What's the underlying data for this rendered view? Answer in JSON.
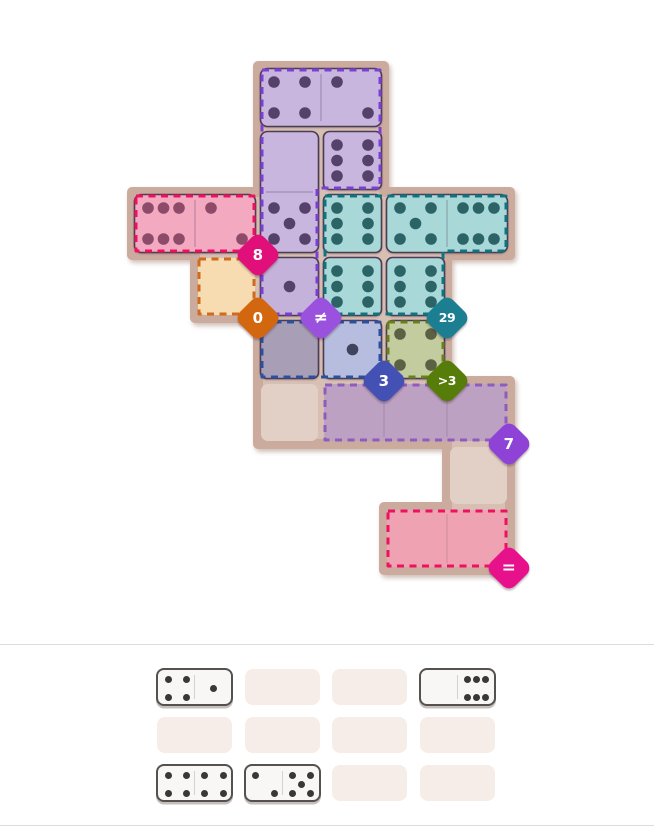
{
  "page": {
    "background": "#ffffff",
    "divider_color": "#dcdcdc",
    "divider_y_top": 644,
    "divider_y_bottom": 825
  },
  "board": {
    "origin": {
      "x": 132,
      "y": 66
    },
    "cell_size": 63,
    "shell": {
      "fill": "#d7bfb4",
      "stroke": "#cbab9e",
      "outline": [
        [
          258,
          66
        ],
        [
          384,
          66
        ],
        [
          384,
          192
        ],
        [
          510,
          192
        ],
        [
          510,
          255
        ],
        [
          447,
          255
        ],
        [
          447,
          381
        ],
        [
          510,
          381
        ],
        [
          510,
          570
        ],
        [
          384,
          570
        ],
        [
          384,
          507
        ],
        [
          447,
          507
        ],
        [
          447,
          444
        ],
        [
          258,
          444
        ],
        [
          258,
          318
        ],
        [
          195,
          318
        ],
        [
          195,
          255
        ],
        [
          132,
          255
        ],
        [
          132,
          192
        ],
        [
          258,
          192
        ]
      ]
    },
    "empty_cells": [
      {
        "name": "cell-cream-empty",
        "col": 1,
        "row": 3,
        "fill": "#f6dcb0"
      },
      {
        "name": "cell-plain-empty-1",
        "col": 2,
        "row": 5,
        "fill": "#e2d0c7"
      },
      {
        "name": "cell-plain-empty-2",
        "col": 5,
        "row": 6,
        "fill": "#e2d0c7"
      }
    ],
    "region_fills": [
      {
        "name": "region-fill-mauve",
        "x": 324,
        "y": 384,
        "w": 183,
        "h": 57,
        "fill": "#bda1c3",
        "dividers_x": [
          384,
          447
        ]
      },
      {
        "name": "region-fill-pink-bottom",
        "x": 387,
        "y": 510,
        "w": 120,
        "h": 57,
        "fill": "#efa3b2",
        "dividers_x": [
          447
        ]
      }
    ],
    "regions": [
      {
        "name": "region-pink-top",
        "dash": "#f01060",
        "points": [
          [
            136,
            196
          ],
          [
            254,
            196
          ],
          [
            254,
            251
          ],
          [
            136,
            251
          ]
        ]
      },
      {
        "name": "region-cream",
        "dash": "#d06a1d",
        "points": [
          [
            199,
            259
          ],
          [
            254,
            259
          ],
          [
            254,
            314
          ],
          [
            199,
            314
          ]
        ]
      },
      {
        "name": "region-purple",
        "dash": "#7c3fd3",
        "points": [
          [
            262,
            70
          ],
          [
            380,
            70
          ],
          [
            380,
            188
          ],
          [
            317,
            188
          ],
          [
            317,
            314
          ],
          [
            262,
            314
          ]
        ]
      },
      {
        "name": "region-teal",
        "dash": "#0f7380",
        "points": [
          [
            325,
            196
          ],
          [
            506,
            196
          ],
          [
            506,
            251
          ],
          [
            443,
            251
          ],
          [
            443,
            314
          ],
          [
            325,
            314
          ]
        ]
      },
      {
        "name": "region-blue",
        "dash": "#2b509f",
        "points": [
          [
            262,
            322
          ],
          [
            380,
            322
          ],
          [
            380,
            377
          ],
          [
            262,
            377
          ]
        ]
      },
      {
        "name": "region-olive",
        "dash": "#68811c",
        "points": [
          [
            388,
            322
          ],
          [
            443,
            322
          ],
          [
            443,
            377
          ],
          [
            388,
            377
          ]
        ]
      },
      {
        "name": "region-mauve",
        "dash": "#8e5cbe",
        "points": [
          [
            325,
            385
          ],
          [
            506,
            385
          ],
          [
            506,
            440
          ],
          [
            325,
            440
          ]
        ]
      },
      {
        "name": "region-pink-bottom",
        "dash": "#f01060",
        "points": [
          [
            388,
            511
          ],
          [
            506,
            511
          ],
          [
            506,
            566
          ],
          [
            388,
            566
          ]
        ]
      }
    ],
    "dominoes": [
      {
        "name": "domino-4-2",
        "merged": true,
        "halves": [
          {
            "col": 2,
            "row": 0,
            "v": "4",
            "fill": "#c9b6df",
            "pip": "#554169"
          },
          {
            "col": 3,
            "row": 0,
            "v": "2",
            "fill": "#c9b6df",
            "pip": "#554169"
          }
        ]
      },
      {
        "name": "domino-0-5",
        "merged": true,
        "halves": [
          {
            "col": 2,
            "row": 1,
            "v": "0",
            "fill": "#c9b6df",
            "pip": "#554169"
          },
          {
            "col": 2,
            "row": 2,
            "v": "5",
            "fill": "#c9b6df",
            "pip": "#554169"
          }
        ]
      },
      {
        "name": "domino-6-6",
        "merged": false,
        "halves": [
          {
            "col": 3,
            "row": 1,
            "v": "6v",
            "fill": "#c9b6df",
            "pip": "#554169"
          },
          {
            "col": 3,
            "row": 2,
            "v": "6v",
            "fill": "#a8d8d8",
            "pip": "#2c6367"
          }
        ]
      },
      {
        "name": "domino-6-2",
        "merged": true,
        "halves": [
          {
            "col": 0,
            "row": 2,
            "v": "6h",
            "fill": "#f3aac1",
            "pip": "#8e4a69"
          },
          {
            "col": 1,
            "row": 2,
            "v": "2",
            "fill": "#f3aac1",
            "pip": "#8e4a69"
          }
        ]
      },
      {
        "name": "domino-5-6",
        "merged": true,
        "halves": [
          {
            "col": 4,
            "row": 2,
            "v": "5",
            "fill": "#a8d8d8",
            "pip": "#2c6367"
          },
          {
            "col": 5,
            "row": 2,
            "v": "6h",
            "fill": "#a8d8d8",
            "pip": "#2c6367"
          }
        ]
      },
      {
        "name": "domino-1-0",
        "merged": false,
        "halves": [
          {
            "col": 2,
            "row": 3,
            "v": "1",
            "fill": "#c5b2da",
            "pip": "#554169"
          },
          {
            "col": 2,
            "row": 4,
            "v": "0",
            "fill": "#a89fb6",
            "pip": "#3f445c"
          }
        ]
      },
      {
        "name": "domino-6-1",
        "merged": false,
        "halves": [
          {
            "col": 3,
            "row": 3,
            "v": "6v",
            "fill": "#a8d8d8",
            "pip": "#2c6367"
          },
          {
            "col": 3,
            "row": 4,
            "v": "1",
            "fill": "#b6bdde",
            "pip": "#3f445c"
          }
        ]
      },
      {
        "name": "domino-6-4",
        "merged": false,
        "halves": [
          {
            "col": 4,
            "row": 3,
            "v": "6v",
            "fill": "#a8d8d8",
            "pip": "#2c6367"
          },
          {
            "col": 4,
            "row": 4,
            "v": "4",
            "fill": "#c3cc9e",
            "pip": "#5b6144"
          }
        ]
      }
    ],
    "badges": [
      {
        "name": "badge-pink-sum",
        "label": "8",
        "color": "#e00f7a",
        "x": 258,
        "y": 255,
        "size": "num"
      },
      {
        "name": "badge-cream-sum",
        "label": "0",
        "color": "#d2670f",
        "x": 258,
        "y": 318,
        "size": "num"
      },
      {
        "name": "badge-not-equal",
        "label": "≠",
        "color": "#9a51dd",
        "x": 321,
        "y": 318,
        "size": "sym"
      },
      {
        "name": "badge-teal-sum",
        "label": "29",
        "color": "#1b7f91",
        "x": 447,
        "y": 318,
        "size": "small"
      },
      {
        "name": "badge-blue-sum",
        "label": "3",
        "color": "#4351b5",
        "x": 384,
        "y": 381,
        "size": "num"
      },
      {
        "name": "badge-olive-gt",
        "label": ">3",
        "color": "#567d0a",
        "x": 447,
        "y": 381,
        "size": "small"
      },
      {
        "name": "badge-mauve-sum",
        "label": "7",
        "color": "#8e43d6",
        "x": 509,
        "y": 444,
        "size": "num"
      },
      {
        "name": "badge-equal",
        "label": "=",
        "color": "#e8118c",
        "x": 509,
        "y": 568,
        "size": "sym"
      }
    ],
    "pip_layouts": {
      "0": [],
      "1": [
        [
          1,
          1
        ]
      ],
      "2": [
        [
          0,
          0
        ],
        [
          2,
          2
        ]
      ],
      "4": [
        [
          0,
          0
        ],
        [
          0,
          2
        ],
        [
          2,
          0
        ],
        [
          2,
          2
        ]
      ],
      "5": [
        [
          0,
          0
        ],
        [
          0,
          2
        ],
        [
          1,
          1
        ],
        [
          2,
          0
        ],
        [
          2,
          2
        ]
      ],
      "6h": [
        [
          0,
          0
        ],
        [
          0,
          1
        ],
        [
          0,
          2
        ],
        [
          2,
          0
        ],
        [
          2,
          1
        ],
        [
          2,
          2
        ]
      ],
      "6v": [
        [
          0,
          0
        ],
        [
          0,
          2
        ],
        [
          1,
          0
        ],
        [
          1,
          2
        ],
        [
          2,
          0
        ],
        [
          2,
          2
        ]
      ]
    }
  },
  "tray": {
    "origin": {
      "x": 157,
      "y": 669
    },
    "slot": {
      "w": 75,
      "h": 36,
      "pitch_x": 87.5,
      "pitch_y": 48,
      "rows": 3,
      "cols": 4,
      "fill": "#f6ece8"
    },
    "domino_style": {
      "body": "#f8f7f5",
      "border": "#55514e",
      "pip": "#3a3837",
      "divider": "#d4d1ce"
    },
    "dominoes": [
      {
        "name": "tray-domino-4-1",
        "row": 0,
        "col": 0,
        "halves": [
          "4",
          "1"
        ]
      },
      {
        "name": "tray-domino-0-6",
        "row": 0,
        "col": 3,
        "halves": [
          "0",
          "6h"
        ]
      },
      {
        "name": "tray-domino-4-4",
        "row": 2,
        "col": 0,
        "halves": [
          "4",
          "4"
        ]
      },
      {
        "name": "tray-domino-2-5",
        "row": 2,
        "col": 1,
        "halves": [
          "2",
          "5"
        ]
      }
    ]
  }
}
